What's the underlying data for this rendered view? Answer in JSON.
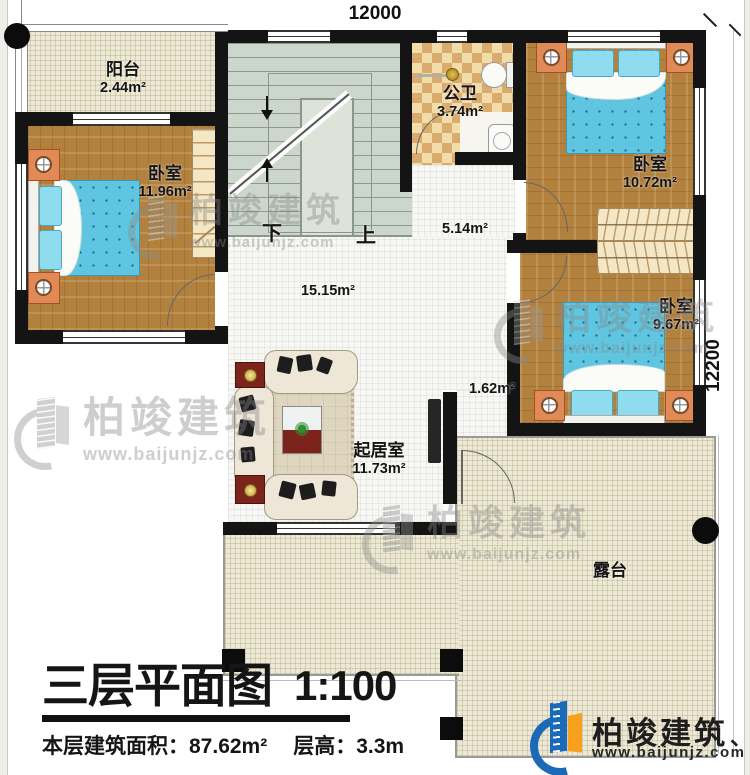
{
  "dimensions": {
    "top": "12000",
    "right": "12200"
  },
  "stairs": {
    "down_label": "下",
    "up_label": "上"
  },
  "rooms": {
    "balcony": {
      "name": "阳台",
      "area": "2.44m²"
    },
    "bedroom_left": {
      "name": "卧室",
      "area": "11.96m²"
    },
    "bathroom": {
      "name": "公卫",
      "area": "3.74m²"
    },
    "bedroom_top_right": {
      "name": "卧室",
      "area": "10.72m²"
    },
    "corridor": {
      "area": "5.14m²"
    },
    "hall": {
      "area": "15.15m²"
    },
    "bedroom_mid_right": {
      "name": "卧室",
      "area": "9.67m²"
    },
    "passage": {
      "area": "1.62m²"
    },
    "living_room": {
      "name": "起居室",
      "area": "11.73m²"
    },
    "terrace": {
      "name": "露台"
    }
  },
  "title_block": {
    "title": "三层平面图",
    "scale": "1:100",
    "area_label": "本层建筑面积：",
    "area_value": "87.62m²",
    "height_label": "层高：",
    "height_value": "3.3m"
  },
  "branding": {
    "watermark_brand": "柏竣建筑",
    "watermark_url": "www.baijunjz.com",
    "logo_brand": "柏竣建筑",
    "logo_mark": "、",
    "logo_url": "www.baijunjz.com"
  },
  "colors": {
    "wall": "#141414",
    "wood_floor": "#b2813e",
    "tile_floor": "#f7f7f4",
    "terrace_floor": "#ece8d5",
    "stair_floor": "#cdd6cc",
    "bathroom_tile": "#f2dcaa",
    "bed_blue": "#5fc5e0",
    "nightstand_orange": "#e08a57",
    "sofa_cream": "#eee7d8",
    "side_table_red": "#7c241c",
    "logo_blue": "#1a6ab8",
    "logo_orange": "#f6a01e"
  }
}
